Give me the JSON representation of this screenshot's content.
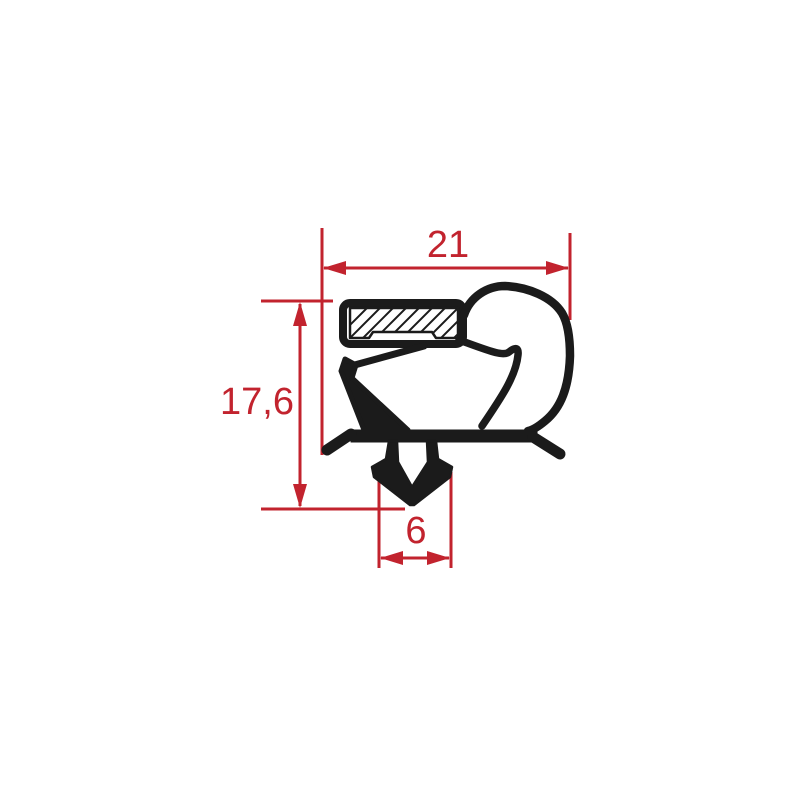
{
  "colors": {
    "dimension_red": "#c2232e",
    "profile_black": "#1b1b1b",
    "background": "#ffffff"
  },
  "dimensions": {
    "width": {
      "label": "21",
      "value": 21
    },
    "height": {
      "label": "17,6",
      "value": 17.6
    },
    "barb_width": {
      "label": "6",
      "value": 6
    }
  }
}
